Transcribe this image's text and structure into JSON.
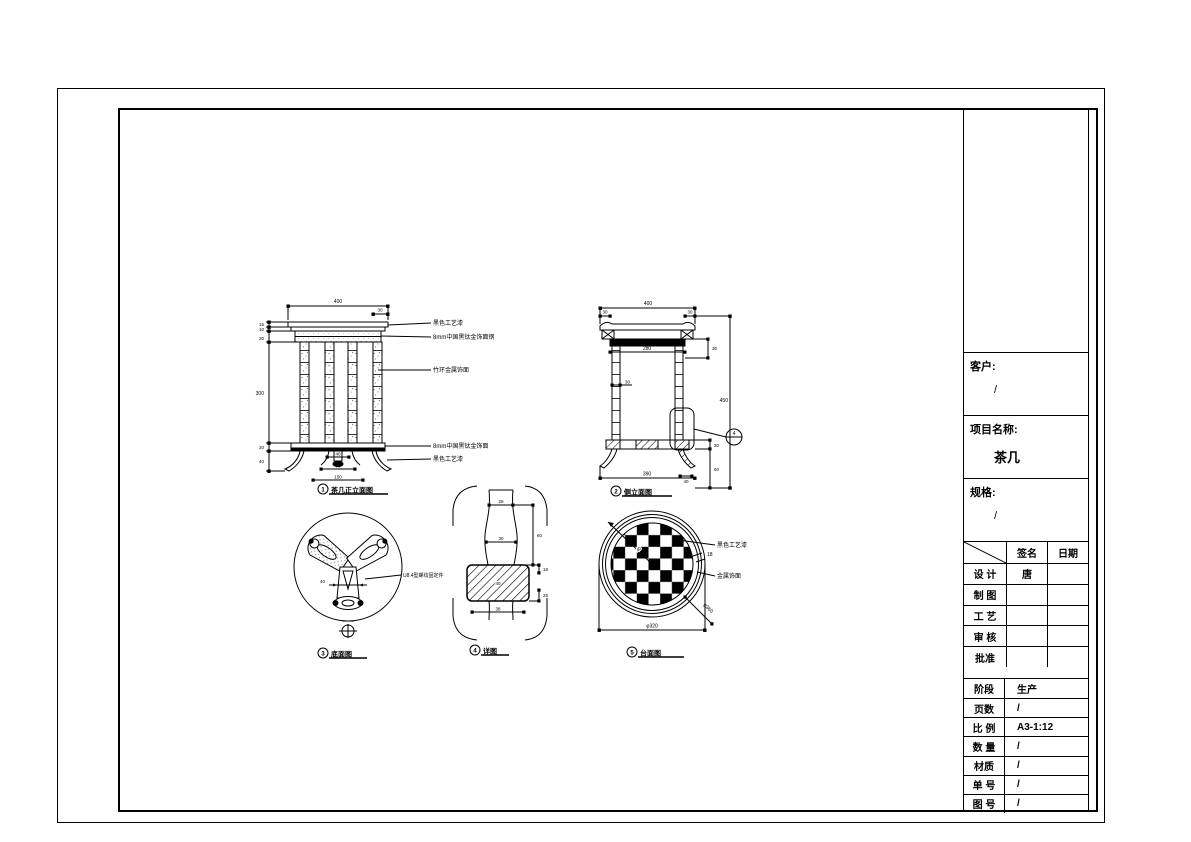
{
  "title_block": {
    "customer": {
      "label": "客户:",
      "value": "/"
    },
    "project": {
      "label": "项目名称:",
      "value": "茶几"
    },
    "spec": {
      "label": "规格:",
      "value": "/"
    },
    "sign_table": {
      "header_sign": "签名",
      "header_date": "日期",
      "rows": [
        {
          "label": "设 计",
          "sign": "唐",
          "date": ""
        },
        {
          "label": "制 图",
          "sign": "",
          "date": ""
        },
        {
          "label": "工 艺",
          "sign": "",
          "date": ""
        },
        {
          "label": "审 核",
          "sign": "",
          "date": ""
        },
        {
          "label": "批准",
          "sign": "",
          "date": ""
        }
      ]
    },
    "prod_table": {
      "rows": [
        {
          "label": "阶段",
          "value": "生产"
        },
        {
          "label": "页数",
          "value": "/"
        },
        {
          "label": "比 例",
          "value": "A3-1:12"
        },
        {
          "label": "数 量",
          "value": "/"
        },
        {
          "label": "材质",
          "value": "/"
        },
        {
          "label": "单 号",
          "value": "/"
        },
        {
          "label": "图 号",
          "value": "/"
        }
      ]
    }
  },
  "front_view": {
    "caption_no": "1",
    "caption": "茶几正立面图",
    "dim_width": "400",
    "dim_overhang": "30",
    "dim_top_a": "15",
    "dim_top_b": "10",
    "dim_top_c": "20",
    "dim_leg_height": "300",
    "dim_stretcher": "20",
    "dim_foot_h": "40",
    "dim_pad": "40",
    "dim_inner": "70",
    "dim_base": "150",
    "ann_top_a": "黑色工艺漆",
    "ann_top_b": "8mm中国黑钛金饰面钢",
    "ann_leg": "竹环金属饰面",
    "ann_bot_a": "8mm中国黑钛金饰面",
    "ann_bot_b": "黑色工艺漆"
  },
  "side_view": {
    "caption_no": "2",
    "caption": "侧立面图",
    "dim_width": "400",
    "dim_overhang_l": "30",
    "dim_overhang_r": "30",
    "dim_inner": "280",
    "dim_apron": "30",
    "dim_leg_w": "30",
    "dim_height": "450",
    "dim_stretcher": "30",
    "dim_foot_h": "60",
    "dim_pad": "40",
    "dim_bottom": "390",
    "detail_ref": "4"
  },
  "bottom_view": {
    "caption_no": "3",
    "caption": "底面图",
    "dim_leg": "40",
    "annotation": "U8.4型螺纹固定件"
  },
  "detail_view": {
    "caption_no": "4",
    "caption": "详图",
    "dim_top": "28",
    "dim_mid": "30",
    "dim_side": "60",
    "dim_block_a": "18",
    "dim_block_b": "25",
    "dim_block_c": "40",
    "dim_bottom": "38"
  },
  "top_view": {
    "caption_no": "5",
    "caption": "台面图",
    "dim_checker": "40",
    "dim_rim": "18",
    "dim_outer": "φ360",
    "dim_width": "φ320",
    "ann_a": "黑色工艺漆",
    "ann_b": "金属饰面"
  }
}
